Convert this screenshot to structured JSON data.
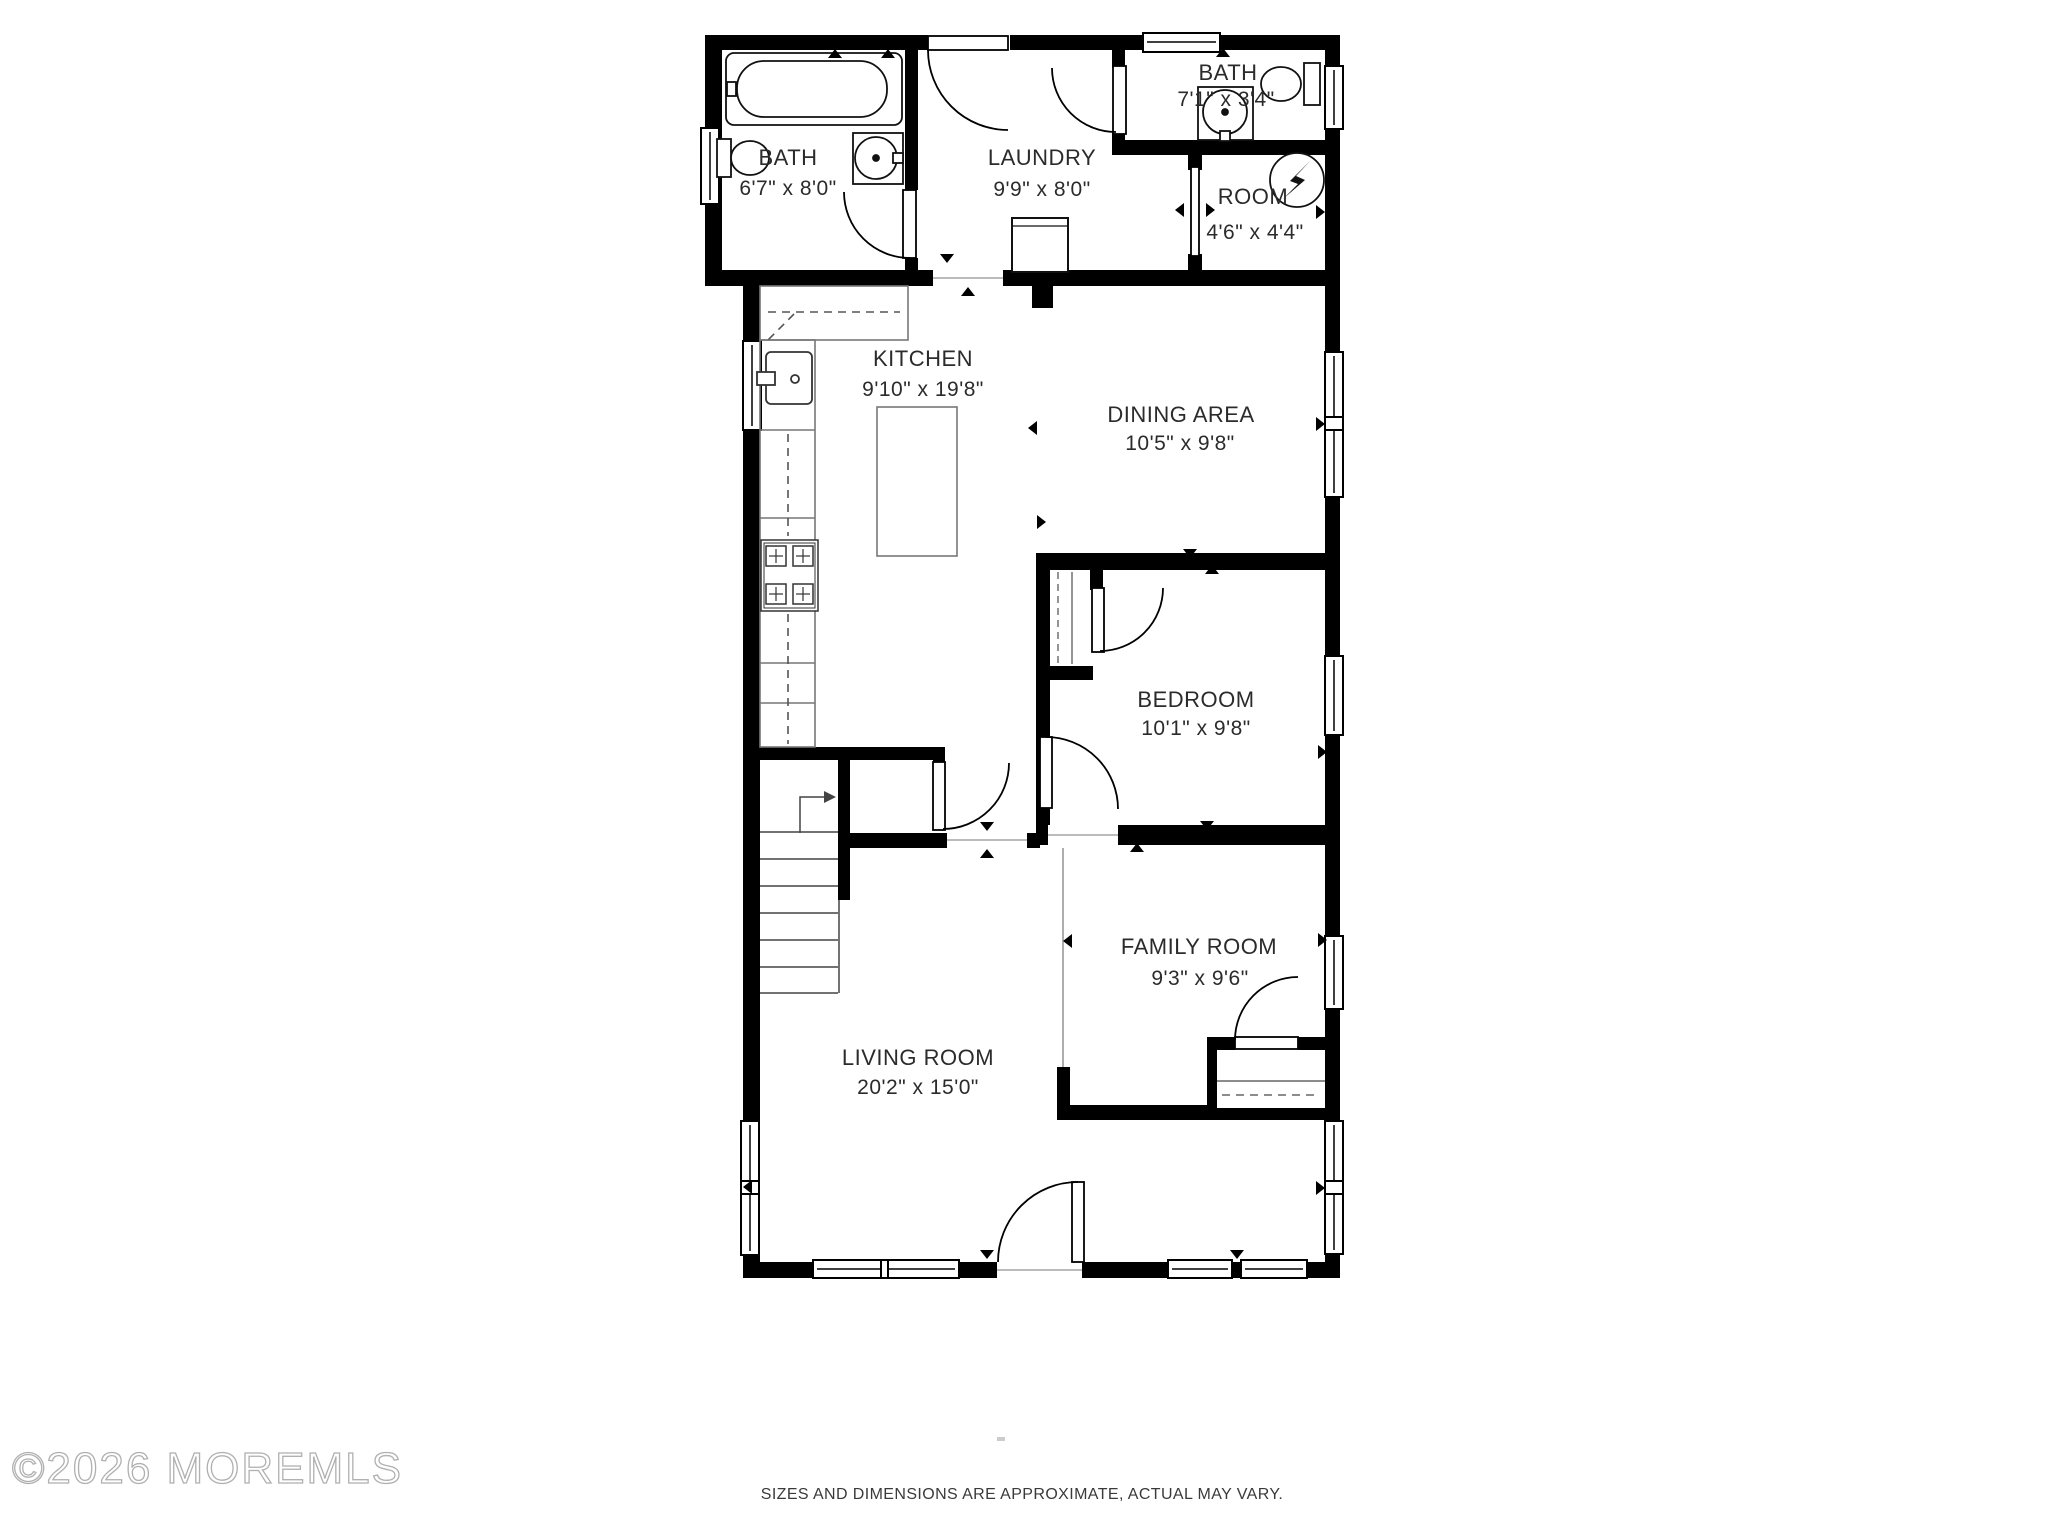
{
  "document": {
    "type": "residential floor plan"
  },
  "rooms": [
    {
      "name": "BATH",
      "dims": "6'7\" x 8'0\""
    },
    {
      "name": "LAUNDRY",
      "dims": "9'9\" x 8'0\""
    },
    {
      "name": "BATH",
      "dims": "7'1\" x 3'4\""
    },
    {
      "name": "ROOM",
      "dims": "4'6\" x 4'4\""
    },
    {
      "name": "KITCHEN",
      "dims": "9'10\" x 19'8\""
    },
    {
      "name": "DINING AREA",
      "dims": "10'5\" x 9'8\""
    },
    {
      "name": "BEDROOM",
      "dims": "10'1\" x 9'8\""
    },
    {
      "name": "FAMILY ROOM",
      "dims": "9'3\" x 9'6\""
    },
    {
      "name": "LIVING ROOM",
      "dims": "20'2\" x 15'0\""
    }
  ],
  "fixtures": [
    "bathtub",
    "toilet",
    "vanity-sink",
    "pedestal-sink",
    "laundry-washer",
    "water-heater",
    "kitchen-sink",
    "stove",
    "kitchen-island",
    "stairs-up",
    "closet-rod"
  ],
  "footer": {
    "copyright": "©2026 MOREMLS",
    "disclaimer": "SIZES AND DIMENSIONS ARE APPROXIMATE, ACTUAL MAY VARY."
  },
  "colors": {
    "walls": "#000000",
    "counters": "#777777",
    "room_divider": "#999999",
    "labels": "#2b2b2b",
    "copyright": "#b5b5b5",
    "disclaimer": "#3a3a3a"
  }
}
